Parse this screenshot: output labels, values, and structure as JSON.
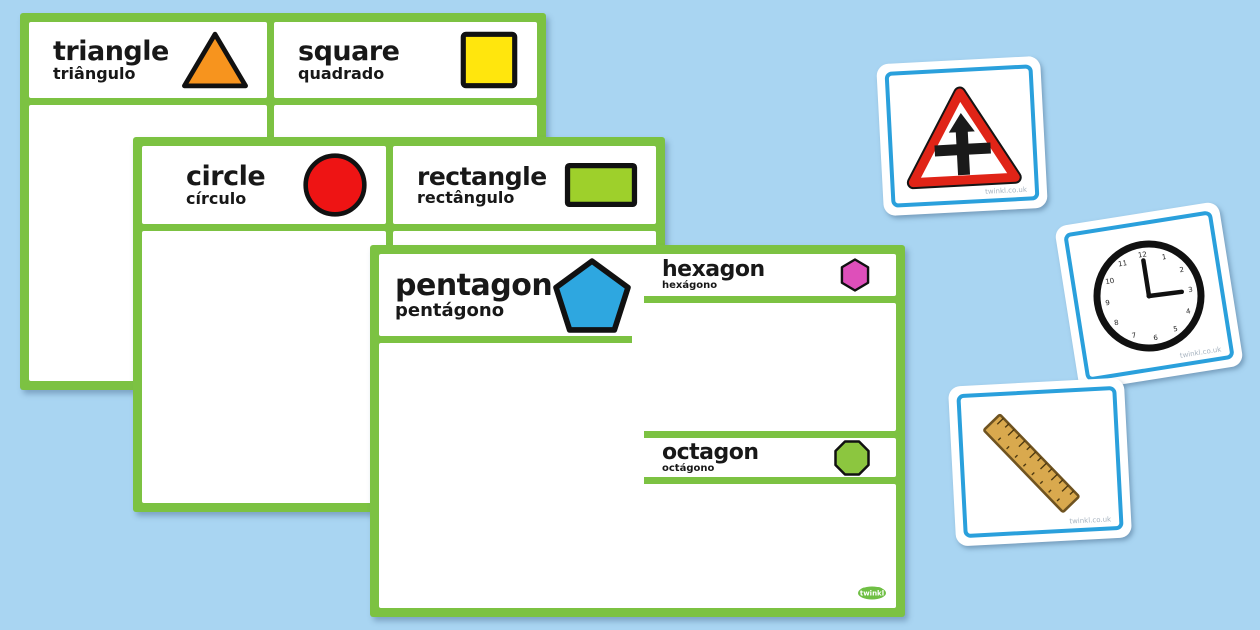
{
  "background_color": "#a9d5f2",
  "mat_border_color": "#7cc242",
  "mats": [
    {
      "name": "triangle-square-sorting-mat",
      "cells": [
        {
          "label_en": "triangle",
          "label_pt": "triângulo",
          "shape": "triangle",
          "shape_color": "#f7941e"
        },
        {
          "label_en": "square",
          "label_pt": "quadrado",
          "shape": "square",
          "shape_color": "#ffe60d"
        }
      ]
    },
    {
      "name": "circle-rectangle-sorting-mat",
      "cells": [
        {
          "label_en": "circle",
          "label_pt": "círculo",
          "shape": "circle",
          "shape_color": "#ee1414"
        },
        {
          "label_en": "rectangle",
          "label_pt": "rectângulo",
          "shape": "rectangle",
          "shape_color": "#9ed02b"
        }
      ]
    },
    {
      "name": "pentagon-hexagon-octagon-sorting-mat",
      "cells": [
        {
          "label_en": "pentagon",
          "label_pt": "pentágono",
          "shape": "pentagon",
          "shape_color": "#2ea7e0"
        },
        {
          "label_en": "hexagon",
          "label_pt": "hexágono",
          "shape": "hexagon",
          "shape_color": "#de4fba"
        },
        {
          "label_en": "octagon",
          "label_pt": "octágono",
          "shape": "octagon",
          "shape_color": "#8cc63f"
        }
      ]
    }
  ],
  "cards": [
    {
      "name": "road-sign-picture-card",
      "image": "crossroads-warning-sign",
      "watermark": "twinkl.co.uk",
      "sign_red": "#e02417"
    },
    {
      "name": "clock-picture-card",
      "image": "analogue-clock-three-oclock",
      "watermark": "twinkl.co.uk",
      "clock_numerals": [
        "12",
        "1",
        "2",
        "3",
        "4",
        "5",
        "6",
        "7",
        "8",
        "9",
        "10",
        "11"
      ]
    },
    {
      "name": "ruler-picture-card",
      "image": "wooden-ruler",
      "watermark": "twinkl.co.uk",
      "ruler_color": "#d9a94e"
    }
  ],
  "card_border_color": "#2aa0dc",
  "logo": {
    "text": "twinkl",
    "color": "#6fbf44"
  }
}
